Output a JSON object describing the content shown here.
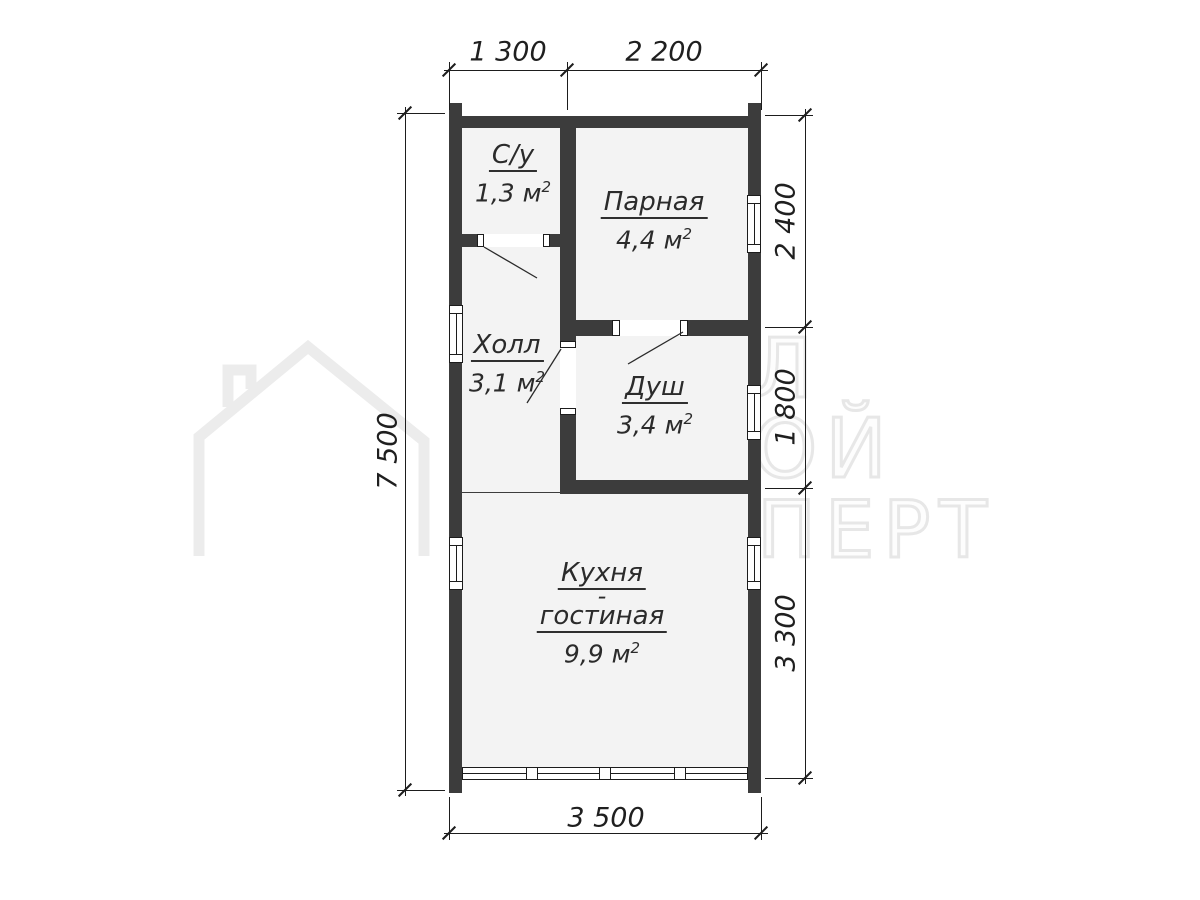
{
  "watermark": {
    "text_lines": [
      "УРАЛ",
      "СТРОЙ",
      "ЭКСПЕРТ"
    ],
    "icon": "house-outline-icon",
    "color": "#e7e7e7"
  },
  "rooms": {
    "su": {
      "name": "С/у",
      "area": "1,3 м",
      "sup": "2"
    },
    "parnaya": {
      "name": "Парная",
      "area": "4,4 м",
      "sup": "2"
    },
    "holl": {
      "name": "Холл",
      "area": "3,1 м",
      "sup": "2"
    },
    "dush": {
      "name": "Душ",
      "area": "3,4 м",
      "sup": "2"
    },
    "kitchen": {
      "name_line1": "Кухня",
      "name_line2": "-",
      "name_line3": "гостиная",
      "area": "9,9 м",
      "sup": "2"
    }
  },
  "dimensions": {
    "top": [
      "1 300",
      "2 200"
    ],
    "left": [
      "7 500"
    ],
    "right": [
      "2 400",
      "1 800",
      "3 300"
    ],
    "bottom": [
      "3 500"
    ]
  },
  "colors": {
    "wall": "#3c3c3c",
    "room_fill": "#f3f3f3",
    "dimension_line": "#1d1d1d",
    "watermark": "#e7e7e7"
  }
}
